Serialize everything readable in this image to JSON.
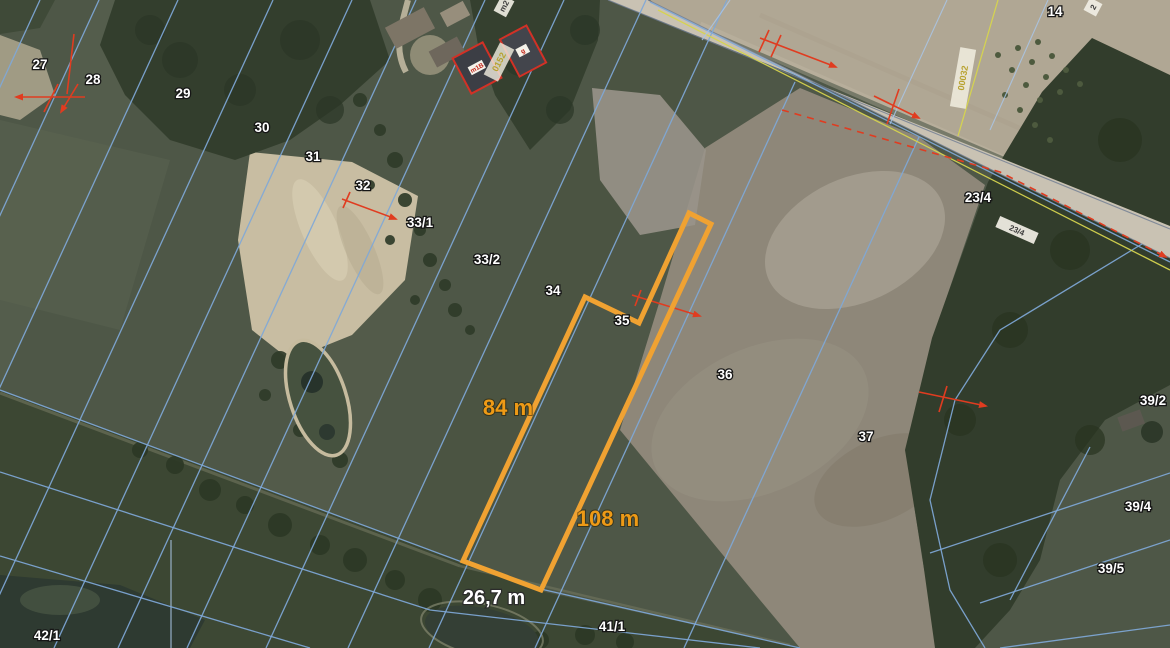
{
  "map": {
    "view": "aerial-cadastral",
    "parcel_labels": [
      "27",
      "28",
      "29",
      "30",
      "31",
      "32",
      "33/1",
      "33/2",
      "34",
      "35",
      "36",
      "37",
      "14",
      "23/4",
      "39/2",
      "39/4",
      "39/5",
      "42/1",
      "41/1"
    ],
    "highlight": {
      "west_length": "84 m",
      "east_length": "108 m",
      "south_length": "26,7 m"
    },
    "building_labels": {
      "left_chip": "m1B",
      "right_chip": "g"
    },
    "micro_labels": {
      "road_chip": "23/4",
      "vertical_yellow": "00032",
      "diagonal_yellow": "0152",
      "top_edge_chip": "m2",
      "top_right_chip": "2"
    },
    "colors": {
      "boundary_blue": "#7fa8d8",
      "boundary_yellow": "#d6d44e",
      "survey_red": "#e03c20",
      "highlight_orange": "#f0a232",
      "measure_orange_text": "#ee9a16",
      "label_white": "#ffffff"
    }
  }
}
